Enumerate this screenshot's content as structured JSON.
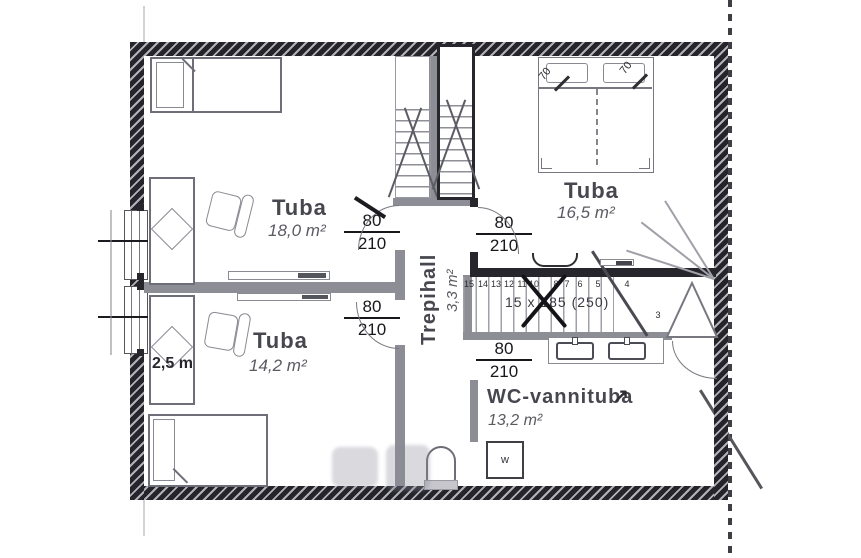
{
  "plan": {
    "rooms": [
      {
        "name": "Tuba",
        "area": "18,0 m²"
      },
      {
        "name": "Tuba",
        "area": "16,5 m²"
      },
      {
        "name": "Tuba",
        "area": "14,2 m²"
      },
      {
        "name": "Trepihall",
        "area": "3,3 m²"
      },
      {
        "name": "WC-vannituba",
        "area": "13,2 m²"
      }
    ],
    "door_dimensions": [
      {
        "width": "80",
        "height": "210"
      },
      {
        "width": "80",
        "height": "210"
      },
      {
        "width": "80",
        "height": "210"
      },
      {
        "width": "80",
        "height": "210"
      }
    ],
    "stairs": {
      "annotation": "15 x 185 (250)",
      "tread_numbers": [
        "15",
        "14",
        "13",
        "12",
        "11",
        "10",
        "8",
        "7",
        "6",
        "5",
        "4",
        "3"
      ]
    },
    "annotations": {
      "length_label": "2,5 m",
      "bed_width_left": "70",
      "bed_width_right": "70",
      "washing_machine": "w"
    },
    "icons": {
      "direction_arrow": "↗"
    },
    "colors": {
      "outer_wall": "#24242a",
      "interior_wall": "#8d8d96",
      "furniture_stroke": "#6e6e78",
      "label_text": "#47474f"
    }
  }
}
